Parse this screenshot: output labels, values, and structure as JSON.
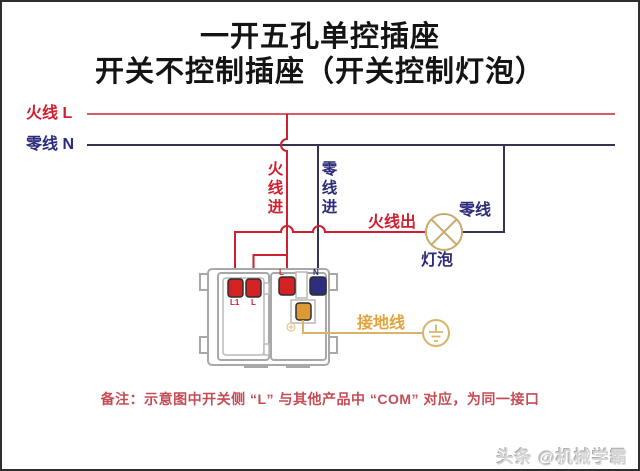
{
  "colors": {
    "live": "#cf2030",
    "neutral_line": "#34344e",
    "neutral_text": "#2b2b7a",
    "gold_wire": "#d9b36a",
    "gold_text": "#e2a43c",
    "lamp_stroke": "#c9aa6d",
    "terminal_red": "#d42222",
    "terminal_navy": "#2e2e7e",
    "terminal_gold": "#dc9a33",
    "device_outline": "#a8a8a8",
    "note": "#c54b55"
  },
  "title": {
    "line1": "一开五孔单控插座",
    "line2": "开关不控制插座（开关控制灯泡）"
  },
  "bus": {
    "live_label": "火线 L",
    "neutral_label": "零线 N"
  },
  "branch_labels": {
    "live_in": "火线进",
    "neutral_in": "零线进",
    "live_out": "火线出",
    "lamp_neutral": "零线",
    "ground": "接地线"
  },
  "lamp": {
    "label": "灯泡"
  },
  "device": {
    "switch_terminal_1": "L1",
    "switch_terminal_2": "L",
    "socket_live": "L",
    "socket_neutral": "N"
  },
  "note": {
    "text": "备注：示意图中开关侧 “L” 与其他产品中 “COM” 对应，为同一接口"
  },
  "watermark": {
    "text": "头条 @机械学霸"
  }
}
